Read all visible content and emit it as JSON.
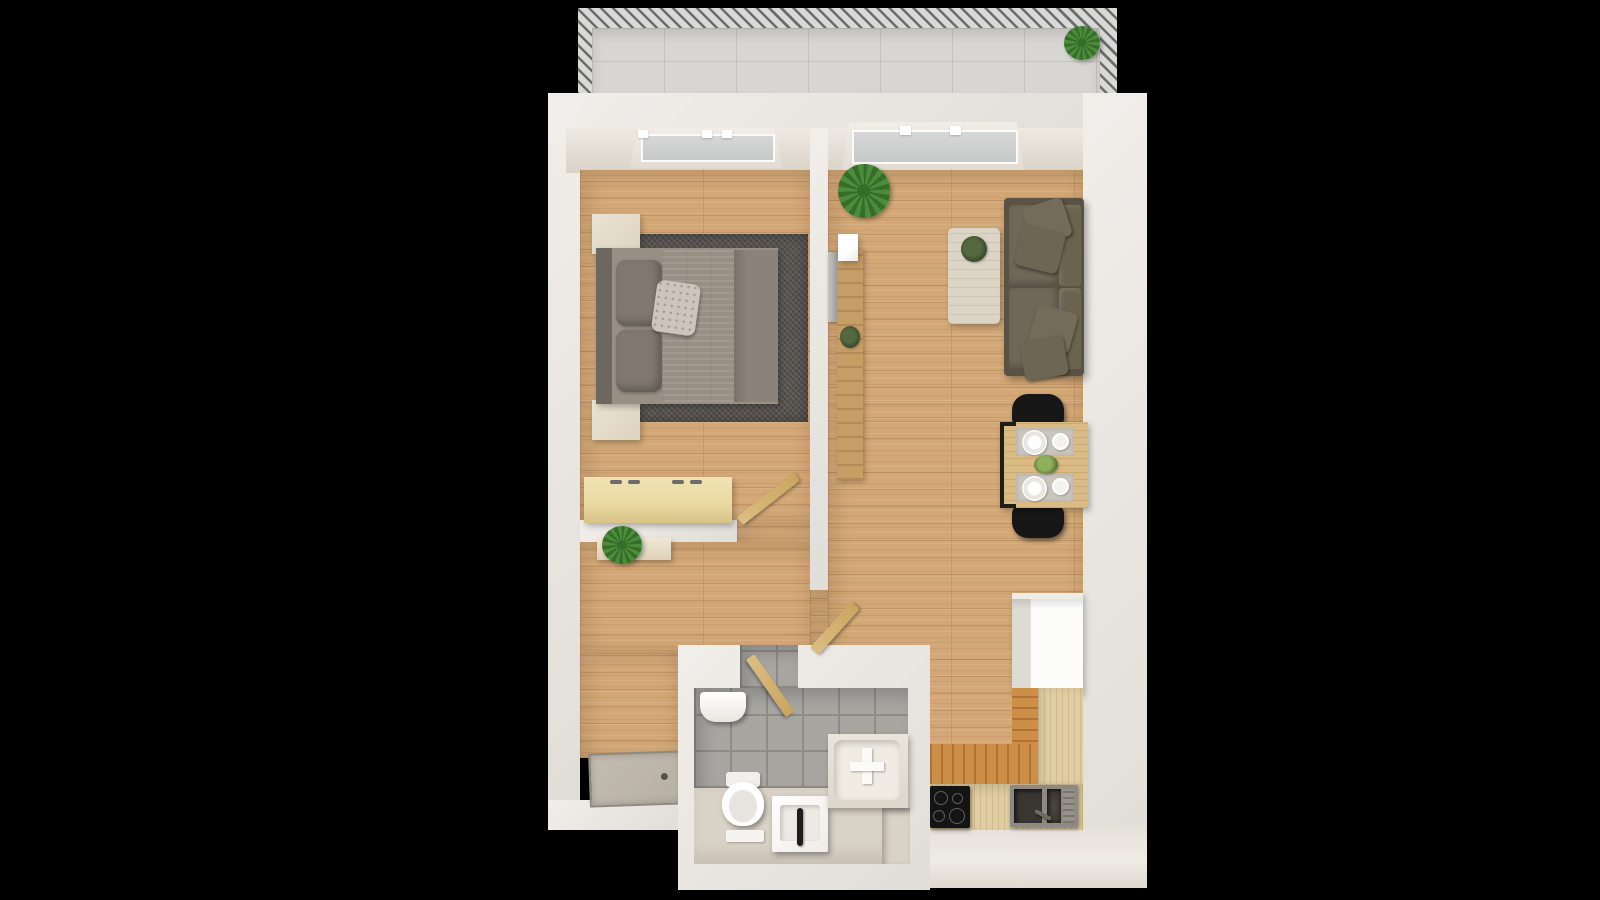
{
  "scene": {
    "type": "3d-floorplan-top-view",
    "description": "Top-down 3D rendering of a one-bedroom apartment with balcony, bedroom, hallway, living room with open kitchen and bathroom"
  },
  "colors": {
    "bg": "#000000",
    "wall": "#eae6e0",
    "wall_face": "#eee9e2",
    "wall_shade": "#d9d2c8",
    "wood": "#d4a876",
    "wood_kitchen": "#cd8f48",
    "counter": "#e0cda3",
    "balcony_floor": "#d8d6d2",
    "railing_dark": "#6d6d6d",
    "railing_light": "#d9d9d7",
    "glass": "#ced1d0",
    "rug": "#55514d",
    "bed_duvet": "#988f85",
    "bed_duvet_plain": "#8b8379",
    "bed_pillow": "#80786f",
    "bed_accent_pillow": "#cdc5bb",
    "headboard": "#6e675f",
    "nightstand": "#eae3d2",
    "dresser": "#ead9a2",
    "sofa": "#6f6858",
    "sofa_frame": "#5a5345",
    "table_wood": "#d9bb83",
    "chair_black": "#171717",
    "coffee_table": "#dcd4c5",
    "fridge": "#fcfcfb",
    "cooktop": "#141414",
    "steel": "#8f8a81",
    "tile": "#a9a6a2",
    "tile_line": "#8f8c88",
    "bath_floor": "#d9d2c6",
    "fixture": "#f7f5f1",
    "plant": "#4d8c3b",
    "plant_dark": "#356e29",
    "door_wood": "#ddbd82",
    "entry_door": "#b7b0a4"
  },
  "rooms": {
    "balcony": {
      "label": "Balcony"
    },
    "bedroom": {
      "label": "Bedroom"
    },
    "hall": {
      "label": "Hallway"
    },
    "living": {
      "label": "Living room with open kitchen"
    },
    "kitchen": {
      "label": "Kitchen"
    },
    "bathroom": {
      "label": "Bathroom"
    }
  },
  "furniture": {
    "railing": "Balcony railing",
    "balcony_plant": "Potted plant",
    "window": "Window",
    "bed": "Double bed",
    "rug": "Area rug",
    "nightstand": "Nightstand",
    "dresser": "Dresser",
    "bedroom_door": "Bedroom door",
    "shelf": "Wall shelf with plant",
    "entry_door": "Entrance door",
    "tv": "Wall-mounted TV",
    "console": "TV console",
    "intercom": "Wall panel",
    "living_plant": "Potted plant",
    "coffee_table": "Coffee table",
    "sofa": "Sofa with cushions",
    "dining_table": "Dining table with place settings",
    "chair": "Dining chair",
    "fridge": "Refrigerator cabinet",
    "kitchen_counter": "Kitchen counter",
    "cooktop": "Induction cooktop",
    "sink": "Kitchen sink",
    "bathroom_door": "Bathroom door",
    "hall_door": "Hall door",
    "boiler": "Water heater",
    "toilet": "Toilet",
    "bath_mat": "Bath mat",
    "washbasin": "Washbasin",
    "bathtub": "Bathtub"
  }
}
